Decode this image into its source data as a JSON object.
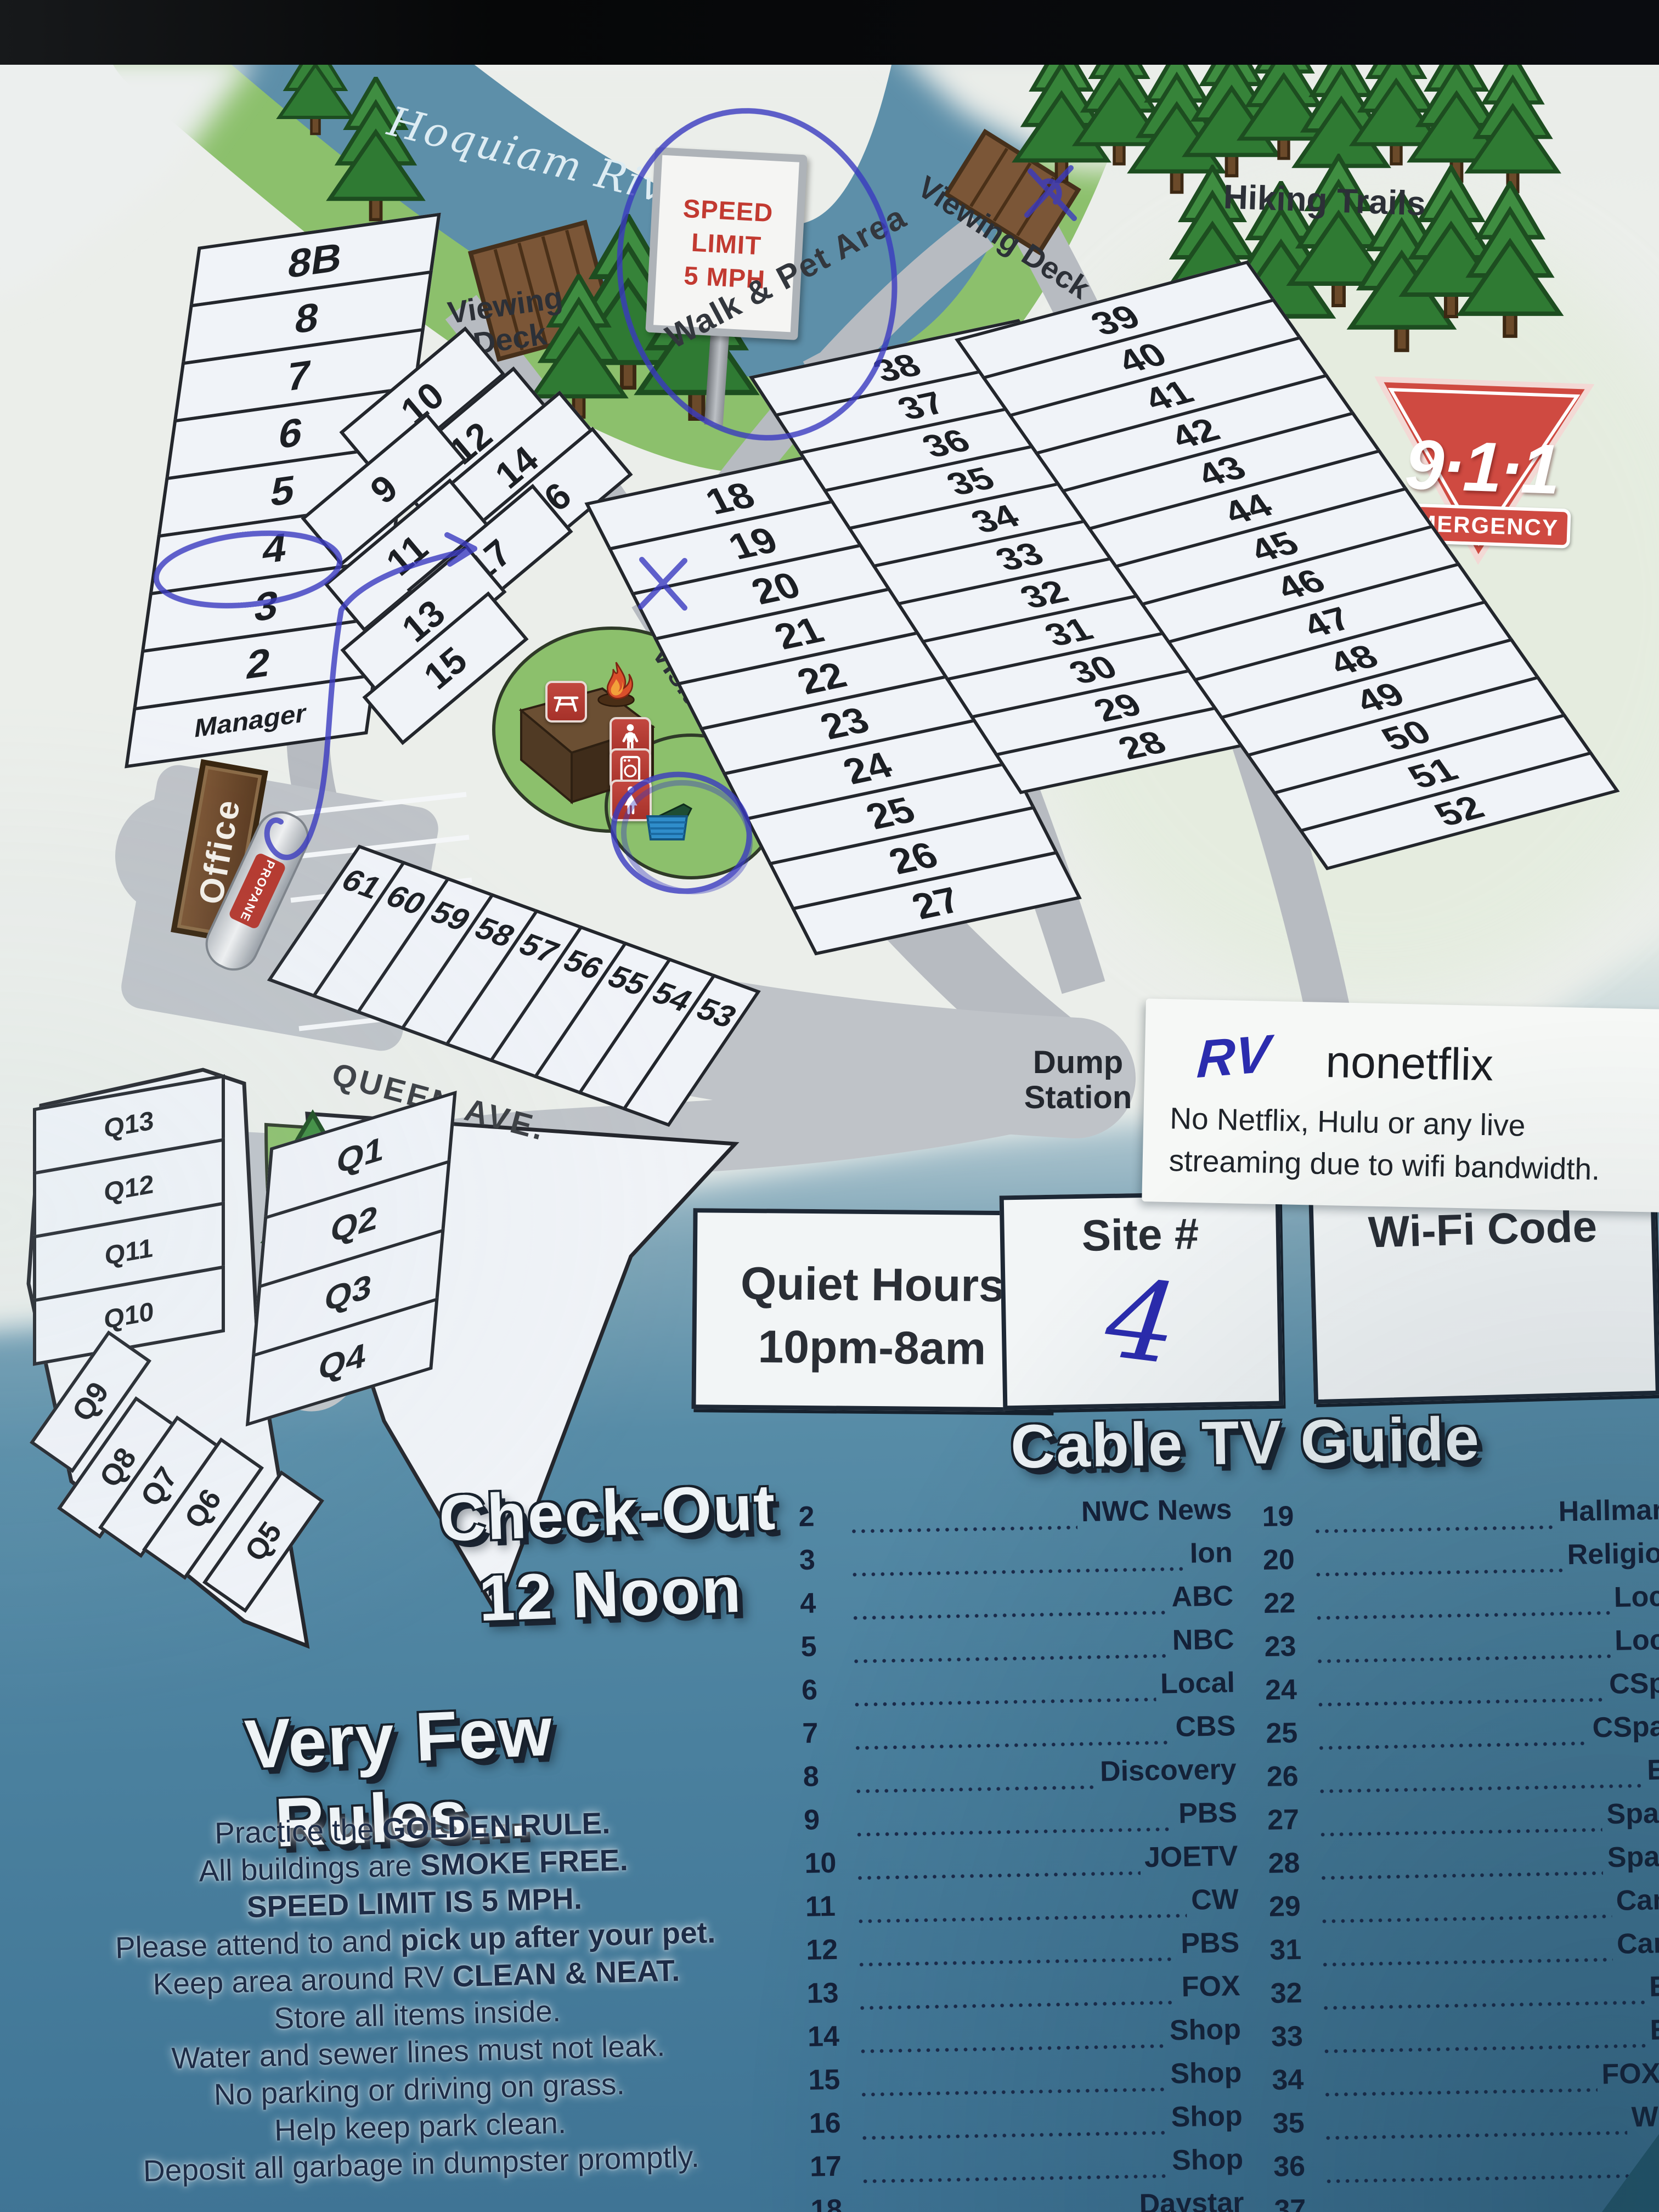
{
  "map": {
    "river": "Hoquiam River",
    "speed_sign": {
      "l1": "SPEED",
      "l2": "LIMIT",
      "l3": "5 MPH"
    },
    "labels": {
      "viewing_deck_1": "Viewing Deck",
      "viewing_deck_2": "Viewing Deck",
      "walk_pet": "Walk & Pet Area",
      "hiking": "Hiking Trails",
      "reserved": "Reserved Group Area",
      "visitor": "Visitor Parking",
      "queen_ave": "QUEEN AVE.",
      "dump": "Dump Station",
      "office": "Office",
      "propane": "PROPANE"
    },
    "emergency": {
      "number": "9·1·1",
      "label": "EMERGENCY"
    },
    "sites": {
      "left": [
        "8B",
        "8",
        "7",
        "6",
        "5",
        "4",
        "3",
        "2",
        "Manager"
      ],
      "cluster": [
        "10",
        "12",
        "14",
        "16",
        "9",
        "11",
        "17",
        "13",
        "15"
      ],
      "col18": [
        "18",
        "19",
        "20",
        "21",
        "22",
        "23",
        "24",
        "25",
        "26",
        "27"
      ],
      "col38": [
        "38",
        "37",
        "36",
        "35",
        "34",
        "33",
        "32",
        "31",
        "30",
        "29",
        "28"
      ],
      "col39": [
        "39",
        "40",
        "41",
        "42",
        "43",
        "44",
        "45",
        "46",
        "47",
        "48",
        "49",
        "50",
        "51",
        "52"
      ],
      "row61": [
        "61",
        "60",
        "59",
        "58",
        "57",
        "56",
        "55",
        "54",
        "53"
      ],
      "q_left": [
        "Q13",
        "Q12",
        "Q11",
        "Q10"
      ],
      "q_fan": [
        "Q9",
        "Q8",
        "Q7",
        "Q6",
        "Q5"
      ],
      "q_right": [
        "Q1",
        "Q2",
        "Q3",
        "Q4"
      ]
    }
  },
  "note": {
    "handwritten": "RV",
    "title": "nonetflix",
    "line1": "No Netflix, Hulu or any live",
    "line2": "streaming due to wifi bandwidth."
  },
  "boxes": {
    "quiet": {
      "line1": "Quiet Hours",
      "line2": "10pm-8am"
    },
    "site": {
      "label": "Site #",
      "value": "4"
    },
    "wifi": {
      "label": "Wi-Fi Code"
    }
  },
  "checkout": {
    "line1": "Check-Out",
    "line2": "12 Noon"
  },
  "cable": {
    "title": "Cable TV Guide",
    "left": [
      [
        "2",
        "NWC News"
      ],
      [
        "3",
        "Ion"
      ],
      [
        "4",
        "ABC"
      ],
      [
        "5",
        "NBC"
      ],
      [
        "6",
        "Local"
      ],
      [
        "7",
        "CBS"
      ],
      [
        "8",
        "Discovery"
      ],
      [
        "9",
        "PBS"
      ],
      [
        "10",
        "JOETV"
      ],
      [
        "11",
        "CW"
      ],
      [
        "12",
        "PBS"
      ],
      [
        "13",
        "FOX"
      ],
      [
        "14",
        "Shop"
      ],
      [
        "15",
        "Shop"
      ],
      [
        "16",
        "Shop"
      ],
      [
        "17",
        "Shop"
      ],
      [
        "18",
        "Daystar"
      ]
    ],
    "right": [
      [
        "19",
        "Hallmark"
      ],
      [
        "20",
        "Religion"
      ],
      [
        "22",
        "Loca"
      ],
      [
        "23",
        "Loca"
      ],
      [
        "24",
        "CSpa"
      ],
      [
        "25",
        "CSpan"
      ],
      [
        "26",
        "Ed"
      ],
      [
        "27",
        "Spani"
      ],
      [
        "28",
        "Spani"
      ],
      [
        "29",
        "Cana"
      ],
      [
        "31",
        "Cana"
      ],
      [
        "32",
        "ES"
      ],
      [
        "33",
        "ES"
      ],
      [
        "34",
        "FOX N"
      ],
      [
        "35",
        "Wea"
      ],
      [
        "36",
        "T"
      ],
      [
        "37",
        ""
      ]
    ]
  },
  "rules": {
    "title": "Very Few Rules...",
    "lines": [
      [
        [
          "Practice the ",
          0
        ],
        [
          "GOLDEN RULE.",
          1
        ]
      ],
      [
        [
          "All buildings are ",
          0
        ],
        [
          "SMOKE FREE.",
          1
        ]
      ],
      [
        [
          "SPEED LIMIT IS 5 MPH.",
          1
        ]
      ],
      [
        [
          "Please attend to and ",
          0
        ],
        [
          "pick up after your pet.",
          1
        ]
      ],
      [
        [
          "Keep area around RV ",
          0
        ],
        [
          "CLEAN & NEAT.",
          1
        ]
      ],
      [
        [
          "Store all items inside.",
          0
        ]
      ],
      [
        [
          "Water and sewer lines must not leak.",
          0
        ]
      ],
      [
        [
          "No parking or driving on grass.",
          0
        ]
      ],
      [
        [
          "Help keep park clean.",
          0
        ]
      ],
      [
        [
          "Deposit all garbage in dumpster promptly.",
          0
        ]
      ]
    ]
  }
}
